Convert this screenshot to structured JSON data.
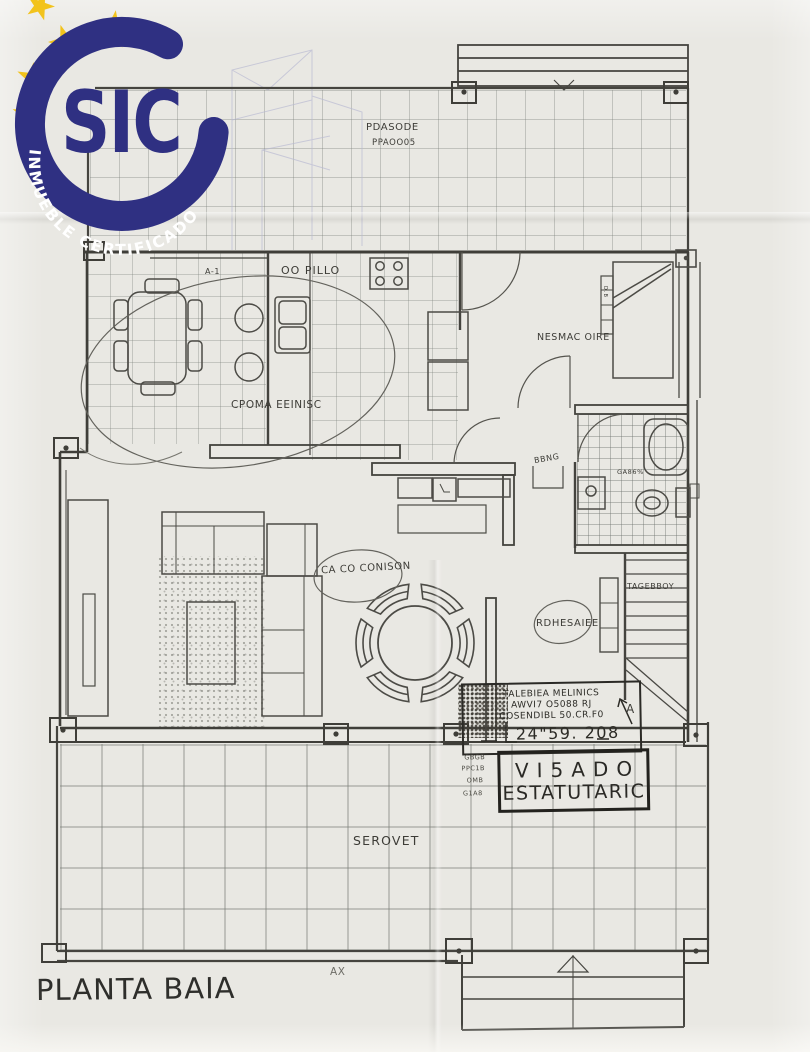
{
  "logo": {
    "brand": "SIC",
    "arc_text": "INMUEBLE CERTIFICADO",
    "navy": "#2f3082",
    "gold": "#f2c31c"
  },
  "plan": {
    "title": "PLANTA BAIA",
    "marks": {
      "sheet": "AX",
      "grid": "A-1",
      "arrow": "A",
      "bed_note": "D.B"
    },
    "labels": {
      "upper_terrace_line1": "PDASODE",
      "upper_terrace_line2": "PPAOO05",
      "kitchen": "OO PILLO",
      "bedroom": "NESMAC OIRE",
      "kitchen_note": "CPOMA EEINISC",
      "living_note": "CA CO CONISON",
      "hall_note": "RDHESAIEE",
      "stairs": "TAGEBBOY",
      "bathroom": "GA86%",
      "niche": "BBNG",
      "lower_terrace": "SEROVET"
    }
  },
  "stamp": {
    "line1": "TALEBIEA MELINICS",
    "line2": "AWVI7 O5088 RJ",
    "line3": "COSENDIBL 50.CR.F0",
    "date": "24\"59. 208",
    "big_line1": "VI5ADO",
    "big_line2": "ESTATUTARIC",
    "side": [
      "GBGB",
      "PPC1B",
      "OMB",
      "G1A8"
    ]
  }
}
